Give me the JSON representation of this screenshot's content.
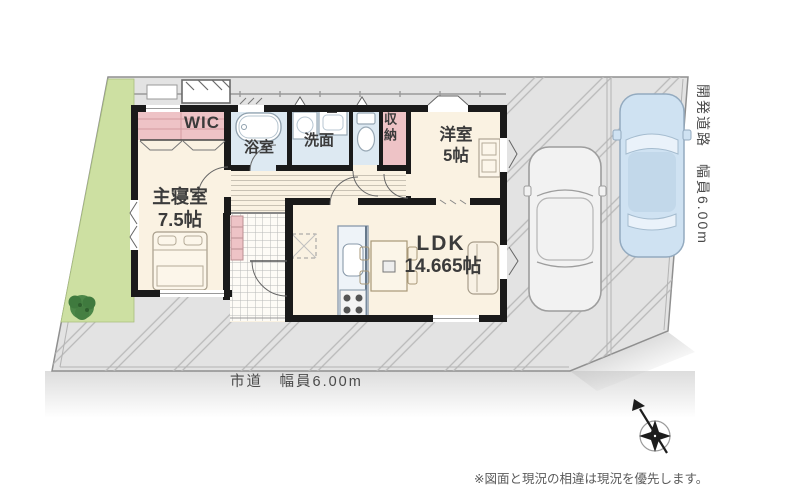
{
  "plan": {
    "rooms": {
      "wic": {
        "label": "WIC"
      },
      "bathroom": {
        "label": "浴室"
      },
      "washroom": {
        "label": "洗面"
      },
      "storage": {
        "label": "収納"
      },
      "western_room": {
        "label": "洋室",
        "size": "5帖"
      },
      "master_bedroom": {
        "label": "主寝室",
        "size": "7.5帖"
      },
      "ldk": {
        "label": "LDK",
        "size": "14.665帖"
      }
    },
    "roads": {
      "south_label": "市道　幅員6.00m",
      "east_label": "開発道路　幅員6.00m"
    },
    "note": "※図面と現況の相違は現況を優先します。",
    "icons": {
      "compass": "compass-rose-icon",
      "tree": "tree-icon",
      "cars": "car-top-view-icon"
    },
    "colors": {
      "wall": "#1a1a1a",
      "room_cream": "#faf2e2",
      "wet_room_blue": "#dde9f2",
      "closet_pink": "#eec3c6",
      "garden_green": "#cde0a2",
      "site_gray": "#e3e3e3",
      "car_blue": "#cfe2f2",
      "tree_green": "#4c8748"
    }
  }
}
